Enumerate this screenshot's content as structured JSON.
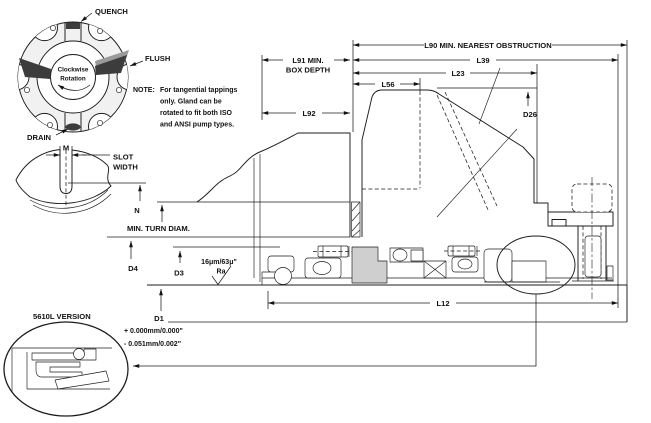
{
  "gland_view": {
    "quench": "QUENCH",
    "flush": "FLUSH",
    "drain": "DRAIN",
    "rotation_line1": "Clockwise",
    "rotation_line2": "Rotation"
  },
  "note": {
    "label": "NOTE:",
    "line1": "For tangential tappings",
    "line2": "only. Gland can be",
    "line3": "rotated to fit both ISO",
    "line4": "and ANSI pump types."
  },
  "slot_view": {
    "m": "M",
    "slot_width_line1": "SLOT",
    "slot_width_line2": "WIDTH",
    "n": "N"
  },
  "dims": {
    "l90": "L90 MIN. NEAREST OBSTRUCTION",
    "l39": "L39",
    "l23": "L23",
    "l56": "L56",
    "l91_line1": "L91 MIN.",
    "l91_line2": "BOX DEPTH",
    "l92": "L92",
    "d26": "D26",
    "l12": "L12",
    "min_turn": "MIN. TURN DIAM.",
    "d4": "D4",
    "d3": "D3",
    "d1": "D1",
    "tol_plus": "+ 0.000mm/0.000\"",
    "tol_minus": "- 0.051mm/0.002\"",
    "surface_finish": "16μm/63μ\"",
    "ra": "Ra"
  },
  "detail": {
    "version_label": "5610L VERSION"
  },
  "colors": {
    "line": "#1c1c1c",
    "dark_fill": "#3c3c3c",
    "gray_fill": "#cfcfcf",
    "background": "#ffffff"
  }
}
